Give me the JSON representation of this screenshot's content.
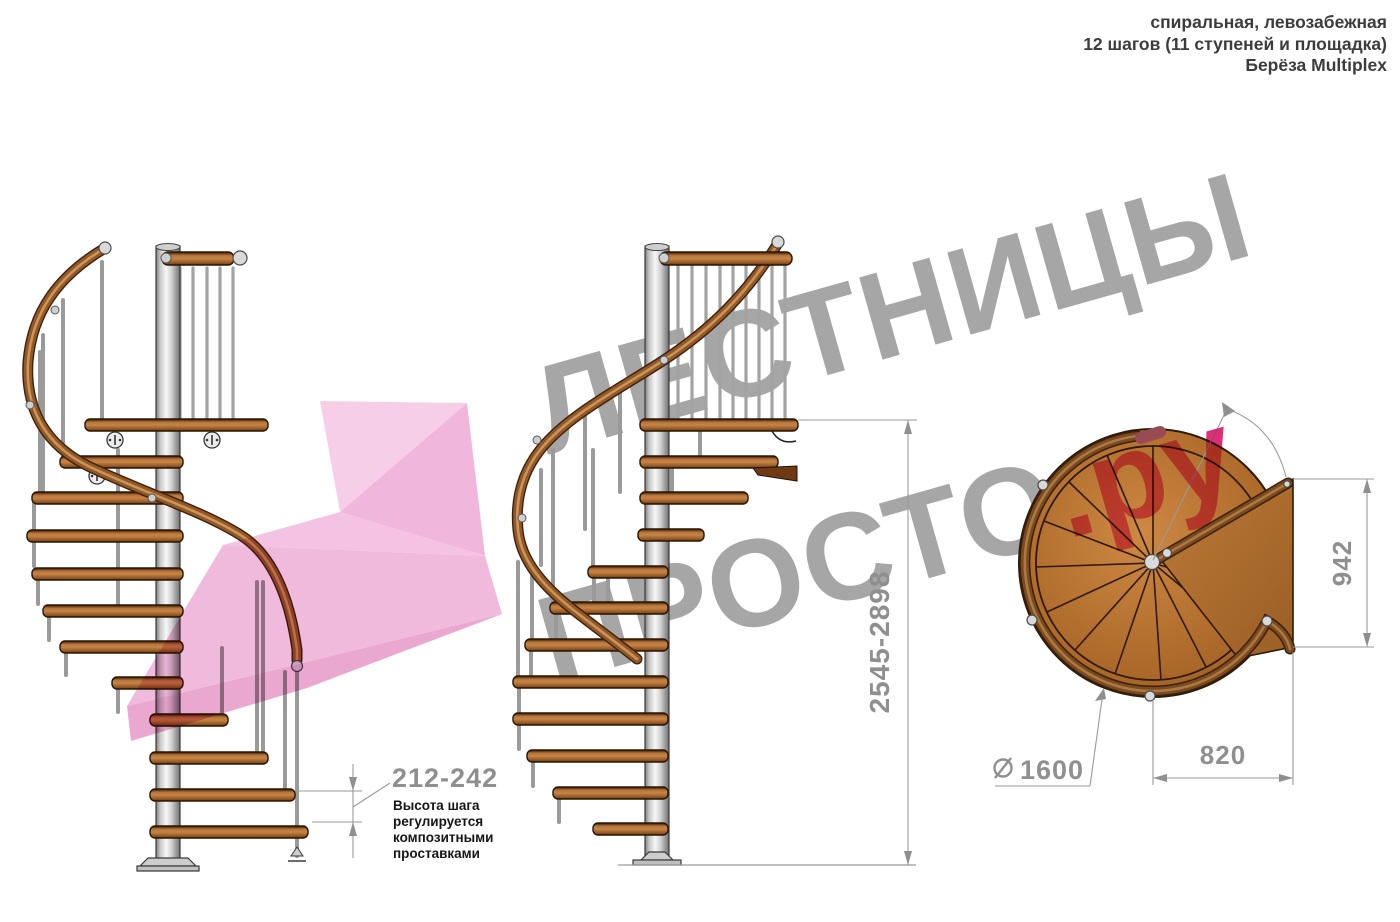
{
  "header": {
    "line1": "спиральная, левозабежная",
    "line2": "12 шагов (11 ступеней и площадка)",
    "line3": "Берёза Multiplex"
  },
  "watermark": {
    "word1": "ЛЕСТНИЦЫ",
    "word2": "ПРОСТО",
    "word2_suffix": ".ру"
  },
  "dims": {
    "step_height": "212-242",
    "step_note_lines": [
      "Высота шага",
      "регулируется",
      "композитными",
      "проставками"
    ],
    "total_height": "2545-2898",
    "landing_side": "942",
    "landing_width": "820",
    "diameter_symbol": "⌀",
    "diameter": "1600"
  },
  "colors": {
    "accent_pink": "#ee66ac",
    "watermark_gray": "#a6a6a6",
    "wood": "#a8682f",
    "rail_dark": "#6b3d16",
    "metal": "#d9d9d9",
    "dimension_gray": "#8f8f8f"
  }
}
